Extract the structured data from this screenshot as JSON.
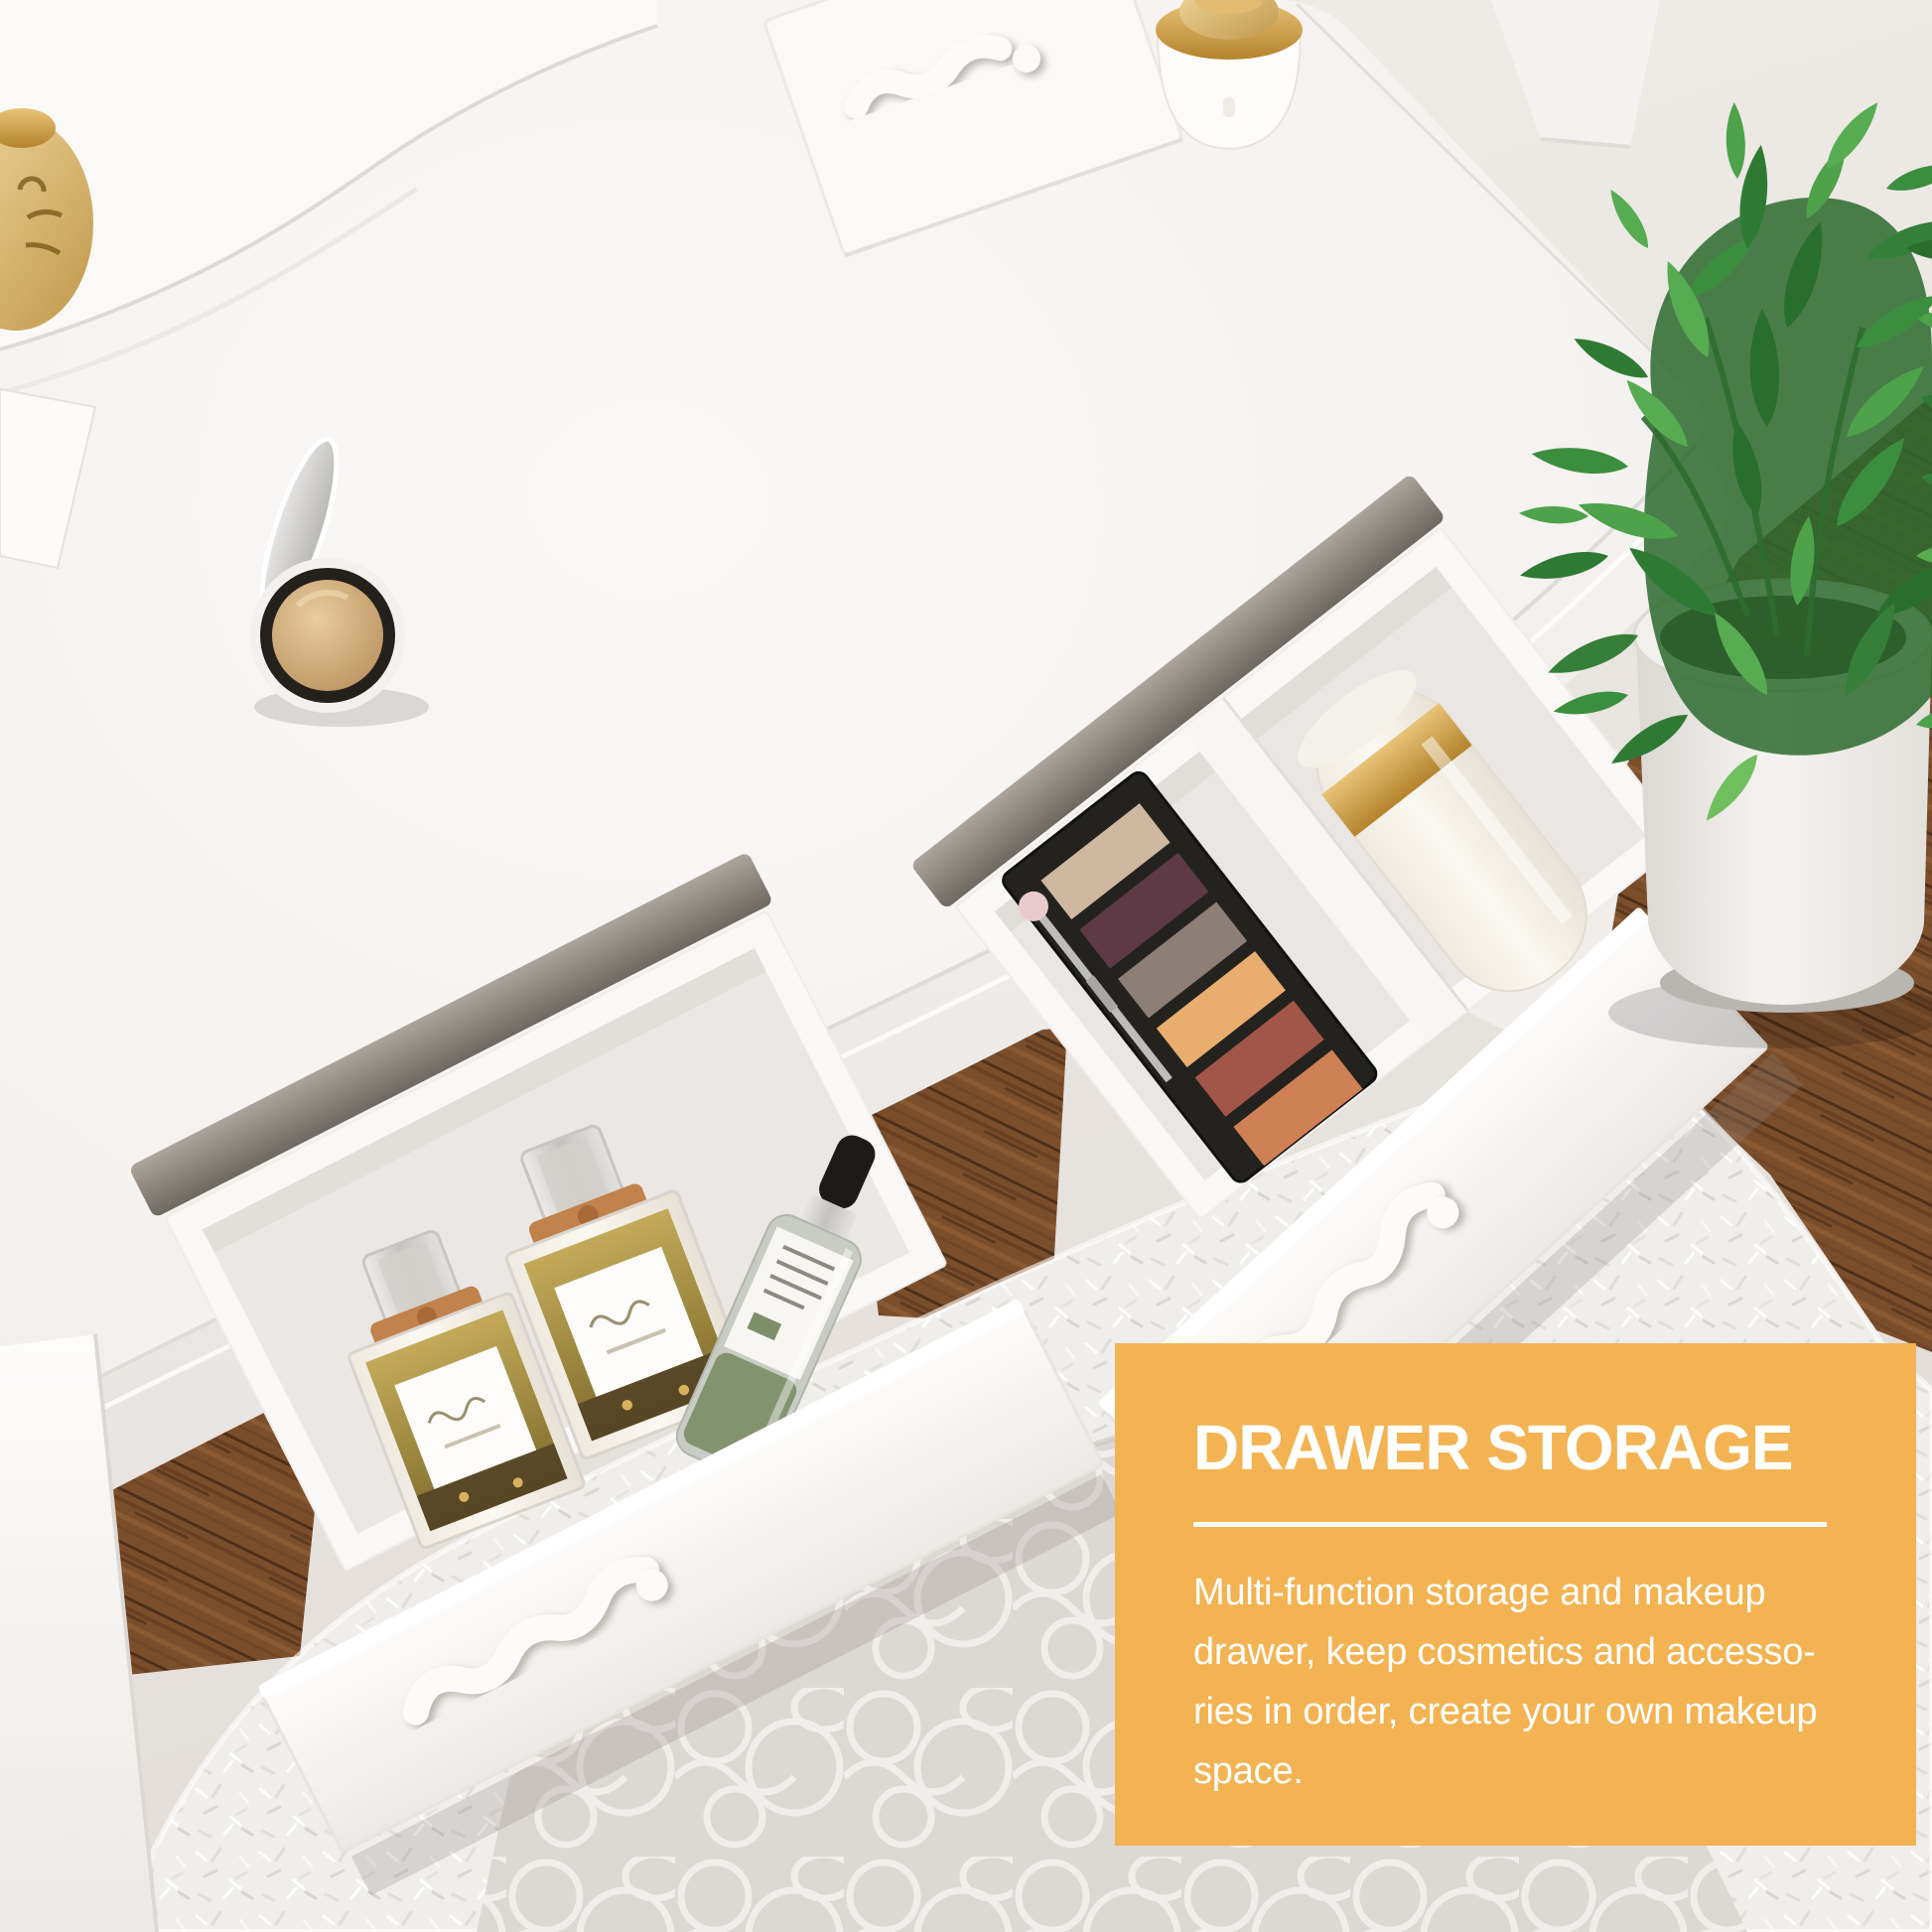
{
  "overlay": {
    "title": "DRAWER STORAGE",
    "body_lines": [
      "Multi-function storage and makeup",
      "drawer, keep cosmetics and accesso-",
      "ries in order, create your own makeup",
      "space."
    ],
    "colors": {
      "panel_background": "#F3B352",
      "title_text": "#FFFFFF",
      "body_text": "#FFFFFF",
      "divider": "#FFFFFF"
    }
  }
}
